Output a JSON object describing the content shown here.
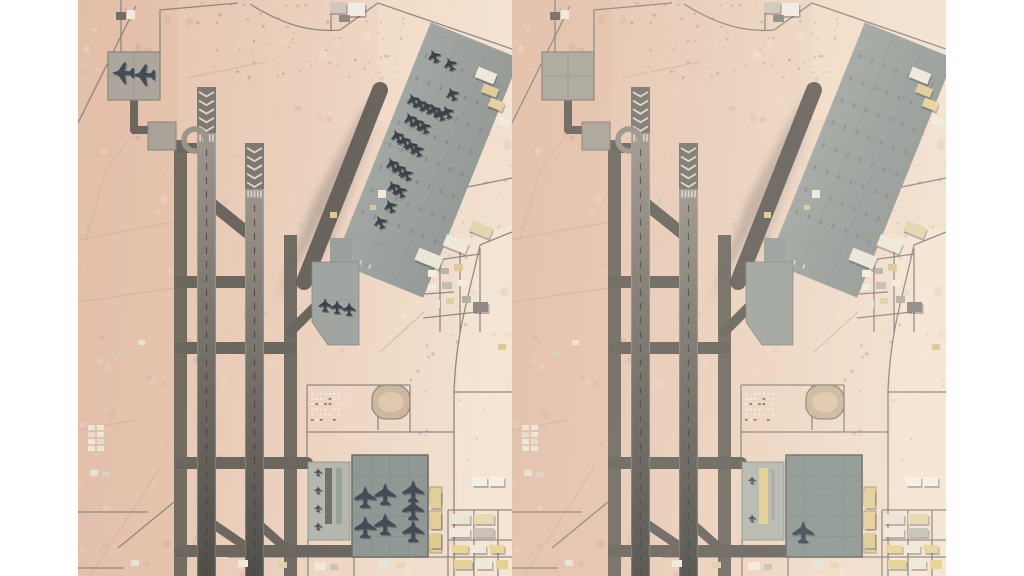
{
  "page": {
    "background": "#ffffff",
    "gutter_width": 78,
    "panel_width": 434,
    "panel_height": 576
  },
  "scene": {
    "palette": {
      "desert_stops": [
        "#e5c3ae",
        "#e7c9b4",
        "#ebd1bd",
        "#efdac7",
        "#f2e0cf"
      ],
      "track": "#ccb19a",
      "road": "#8a857d",
      "taxiway": "#6b675f",
      "runway_light": "#a8a096",
      "runway_dark": "#514f4a",
      "chevron_base": "#7d7970",
      "chevron_mark": "#ded7c9",
      "threshold_bar": "#d8d2c6",
      "apron": "#a2a7a3",
      "apron_dark": "#969b97",
      "apron_grid": "#8d928e",
      "apron_tick": "#757a76",
      "bottom_apron": "#8f9894",
      "west_pad": "#b5b8af",
      "top_pad": "#aca69d",
      "pad_border": "#8a847b",
      "building_white": "#f2efe7",
      "building_tan": "#ddc795",
      "building_yellow": "#e5d194",
      "building_gray": "#b9b3a8",
      "building_dark": "#8f8b84",
      "fighter": "#3b4249",
      "heavy": "#434c55",
      "tiny_plane": "#4a5158",
      "shadow": "rgba(60,55,70,0.32)"
    },
    "panels": [
      {
        "id": "before",
        "overlay": "rgba(0,0,0,0)",
        "pad_strips": [
          {
            "x": 247,
            "y": 468,
            "w": 7,
            "h": 56,
            "c": "#71706a"
          },
          {
            "x": 258,
            "y": 468,
            "w": 6,
            "h": 56,
            "c": "#9aa09a"
          }
        ],
        "aircraft": [
          {
            "t": "heavy",
            "x": 45,
            "y": 73,
            "r": -90
          },
          {
            "t": "heavy",
            "x": 66,
            "y": 75,
            "r": -90
          },
          {
            "t": "fighter",
            "x": 356,
            "y": 56,
            "r": -22
          },
          {
            "t": "fighter",
            "x": 372,
            "y": 64,
            "r": -22
          },
          {
            "t": "fighter",
            "x": 374,
            "y": 94,
            "r": -22
          },
          {
            "t": "fighter",
            "x": 335,
            "y": 100,
            "r": -22
          },
          {
            "t": "fighter",
            "x": 342,
            "y": 104,
            "r": -22
          },
          {
            "t": "fighter",
            "x": 349,
            "y": 107,
            "r": -22
          },
          {
            "t": "fighter",
            "x": 356,
            "y": 110,
            "r": -22
          },
          {
            "t": "fighter",
            "x": 362,
            "y": 114,
            "r": -22
          },
          {
            "t": "fighter",
            "x": 369,
            "y": 112,
            "r": -22
          },
          {
            "t": "fighter",
            "x": 332,
            "y": 119,
            "r": -22
          },
          {
            "t": "fighter",
            "x": 339,
            "y": 123,
            "r": -22
          },
          {
            "t": "fighter",
            "x": 346,
            "y": 127,
            "r": -22
          },
          {
            "t": "fighter",
            "x": 319,
            "y": 136,
            "r": -22
          },
          {
            "t": "fighter",
            "x": 326,
            "y": 141,
            "r": -22
          },
          {
            "t": "fighter",
            "x": 333,
            "y": 146,
            "r": -22
          },
          {
            "t": "fighter",
            "x": 339,
            "y": 150,
            "r": -22
          },
          {
            "t": "fighter",
            "x": 314,
            "y": 164,
            "r": -22
          },
          {
            "t": "fighter",
            "x": 321,
            "y": 169,
            "r": -22
          },
          {
            "t": "fighter",
            "x": 328,
            "y": 174,
            "r": -22
          },
          {
            "t": "fighter",
            "x": 315,
            "y": 187,
            "r": -22
          },
          {
            "t": "fighter",
            "x": 322,
            "y": 191,
            "r": -22
          },
          {
            "t": "fighter",
            "x": 312,
            "y": 206,
            "r": -22
          },
          {
            "t": "fighter",
            "x": 302,
            "y": 222,
            "r": -22
          },
          {
            "t": "fighter",
            "x": 247,
            "y": 305,
            "r": 0
          },
          {
            "t": "fighter",
            "x": 259,
            "y": 307,
            "r": 0
          },
          {
            "t": "fighter",
            "x": 271,
            "y": 309,
            "r": 0
          },
          {
            "t": "heavy",
            "x": 287,
            "y": 497,
            "r": 0
          },
          {
            "t": "heavy",
            "x": 307,
            "y": 494,
            "r": 0
          },
          {
            "t": "heavy",
            "x": 335,
            "y": 491,
            "r": 0
          },
          {
            "t": "heavy",
            "x": 287,
            "y": 527,
            "r": 0
          },
          {
            "t": "heavy",
            "x": 307,
            "y": 524,
            "r": 0
          },
          {
            "t": "heavy",
            "x": 335,
            "y": 509,
            "r": 0
          },
          {
            "t": "heavy",
            "x": 335,
            "y": 531,
            "r": 0
          },
          {
            "t": "tiny",
            "x": 240,
            "y": 472,
            "r": 0
          },
          {
            "t": "tiny",
            "x": 240,
            "y": 490,
            "r": 0
          },
          {
            "t": "tiny",
            "x": 240,
            "y": 508,
            "r": 0
          },
          {
            "t": "tiny",
            "x": 240,
            "y": 526,
            "r": 0
          }
        ]
      },
      {
        "id": "after",
        "overlay": "rgba(255,250,242,0.07)",
        "pad_strips": [
          {
            "x": 247,
            "y": 468,
            "w": 9,
            "h": 56,
            "c": "#e2cf92"
          },
          {
            "x": 259,
            "y": 470,
            "w": 4,
            "h": 50,
            "c": "#aaa9a0"
          }
        ],
        "aircraft": [
          {
            "t": "heavy",
            "x": 291,
            "y": 532,
            "r": 0
          },
          {
            "t": "tiny",
            "x": 240,
            "y": 480,
            "r": 0
          },
          {
            "t": "tiny",
            "x": 240,
            "y": 518,
            "r": 0
          }
        ]
      }
    ]
  }
}
